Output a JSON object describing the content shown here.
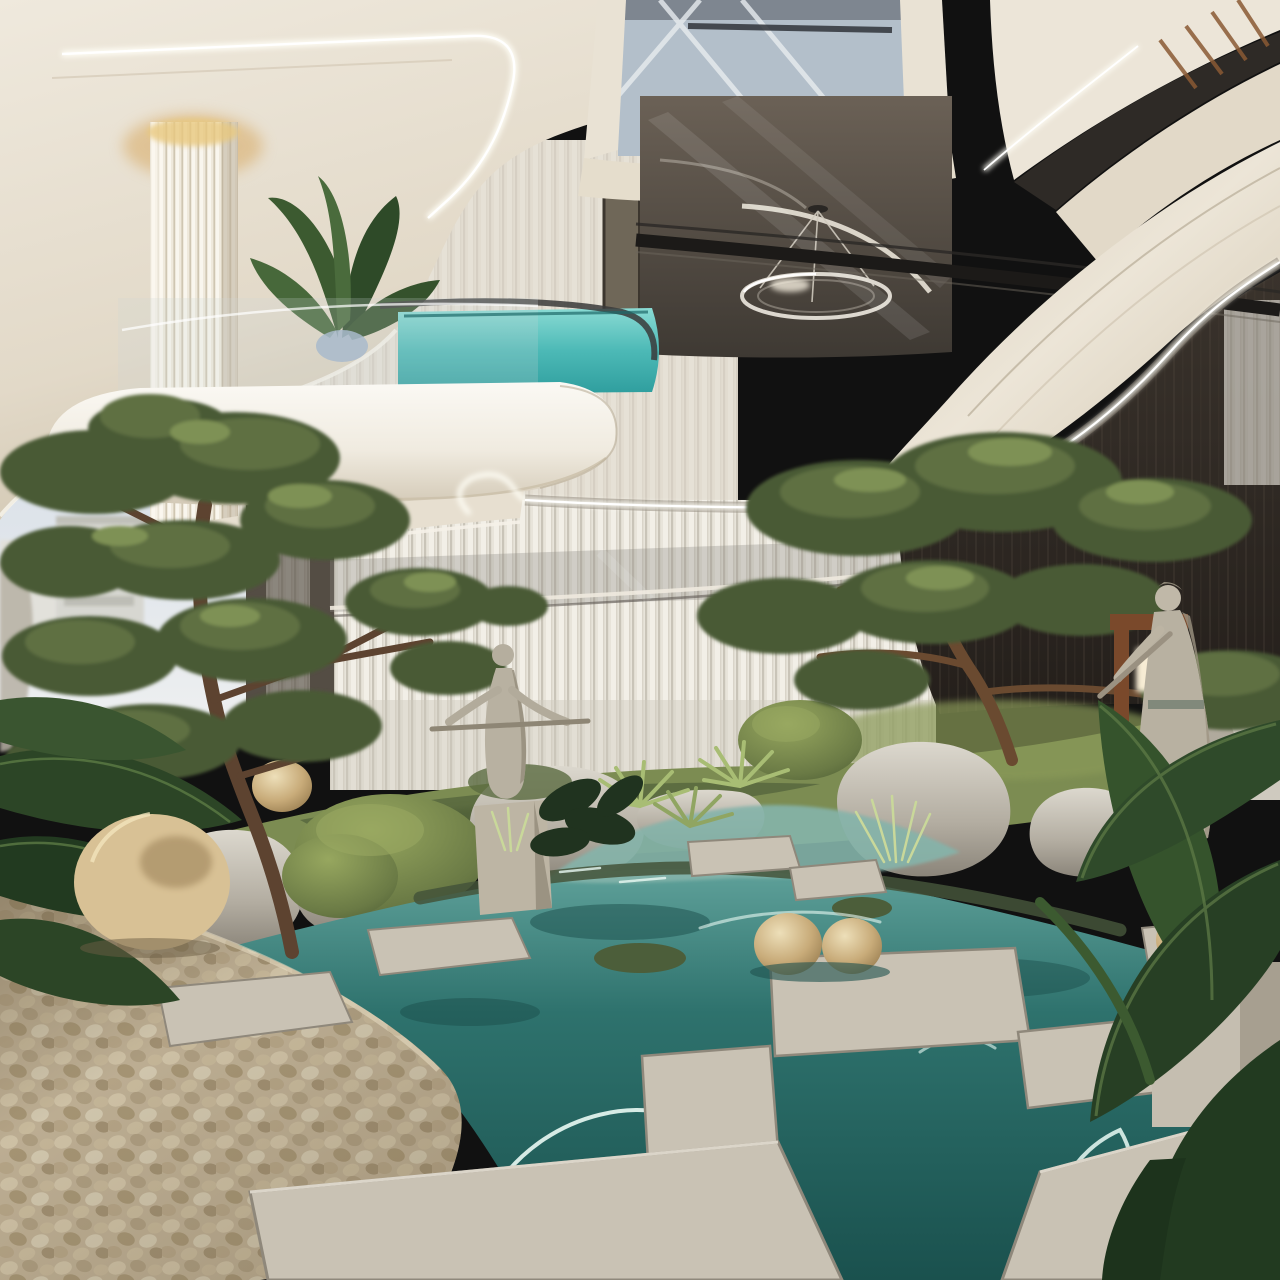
{
  "scene": {
    "kind": "photorealistic-architectural-render",
    "subject": "luxury-atrium-zen-garden-with-koi-pond",
    "elements": [
      "sky",
      "distant-building",
      "curved-cream-balconies",
      "led-light-strips",
      "fluted-column",
      "glass-pool-balcony",
      "banana-plant",
      "ring-chandelier",
      "glass-railing",
      "curtain-wall",
      "dark-interior-wall",
      "wood-slat-accent",
      "left-pine-tree",
      "right-bonsai-pine",
      "moss-bank",
      "boulders",
      "clipped-shrubs",
      "fan-palms",
      "pond-water",
      "caustic-reflections",
      "stepping-stones",
      "pebble-mound",
      "stone-spheres",
      "flute-player-statue-center",
      "flute-player-statue-right",
      "wooden-lantern-frame",
      "tropical-leaves"
    ]
  },
  "palette": {
    "sky_top": "#c7d2e3",
    "sky_bottom": "#edeff0",
    "cream_light": "#f3eee4",
    "cream": "#e7dfd0",
    "cream_shadow": "#cfc4af",
    "slab_white": "#f6f3ec",
    "led": "#fffef6",
    "gold_glow": "#d9af6d",
    "ceiling_dark": "#554c44",
    "dark_wall": "#2c2620",
    "wood_slat": "#8a5a34",
    "glass_blue": "#b3bfca",
    "curtain": "#e8e4da",
    "curtain_stripe": "#d2cdc2",
    "pool_deep": "#2f9e9e",
    "pond_deep": "#1c5955",
    "stream": "#85b4aa",
    "caustic": "#eafaf4",
    "grass": "#7c8c52",
    "moss": "#55653d",
    "pine_dark": "#4a5a36",
    "pine_mid": "#5f7042",
    "pine_light": "#7e9154",
    "leaf_dark": "#2b4426",
    "leaf_mid": "#3c5a30",
    "boulder": "#b3ada1",
    "boulder_light": "#d8d4ca",
    "slab_stone": "#c9c2b4",
    "slab_edge": "#948d7f",
    "pebble": "#c3b499",
    "sphere": "#d8c195",
    "statue": "#b8b1a1",
    "statue_shadow": "#96907f",
    "wood": "#7a492b",
    "lantern": "#f7ecd4",
    "rail_dark": "#1c1a18",
    "trunk": "#5d4330"
  }
}
